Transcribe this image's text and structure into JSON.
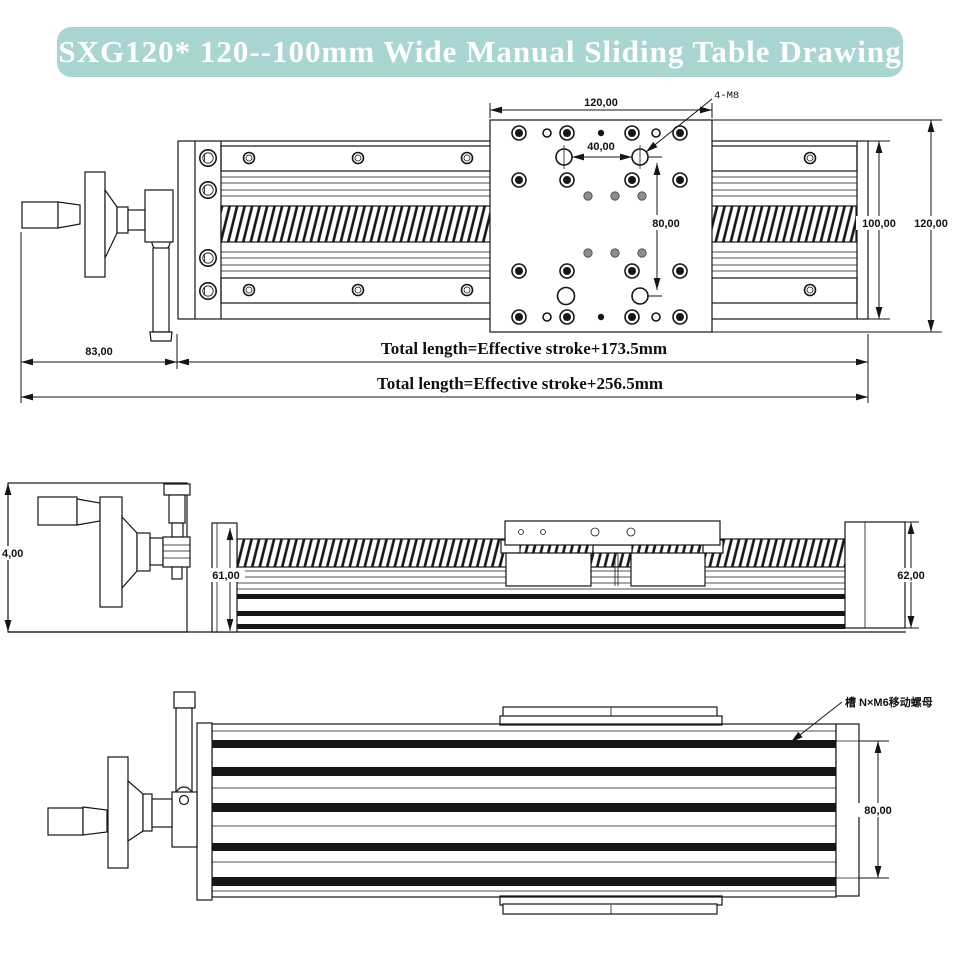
{
  "title": "SXG120* 120--100mm Wide Manual Sliding Table Drawing",
  "colors": {
    "banner": "#a9d6d2",
    "ink": "#161616"
  },
  "top_view": {
    "plate_width": "120,00",
    "hole_pitch_x": "40,00",
    "hole_pitch_y": "80,00",
    "body_width": "100,00",
    "plate_height": "120,00",
    "handle_length": "83,00",
    "mount_holes_label": "4-M8",
    "total_length_short": "Total length=Effective stroke+173.5mm",
    "total_length_long": "Total length=Effective stroke+256.5mm"
  },
  "side_view": {
    "left_height": "4,00",
    "body_height": "61,00",
    "end_height": "62,00"
  },
  "bottom_view": {
    "slide_width": "80,00",
    "slot_label": "槽 N×M6移动螺母"
  }
}
